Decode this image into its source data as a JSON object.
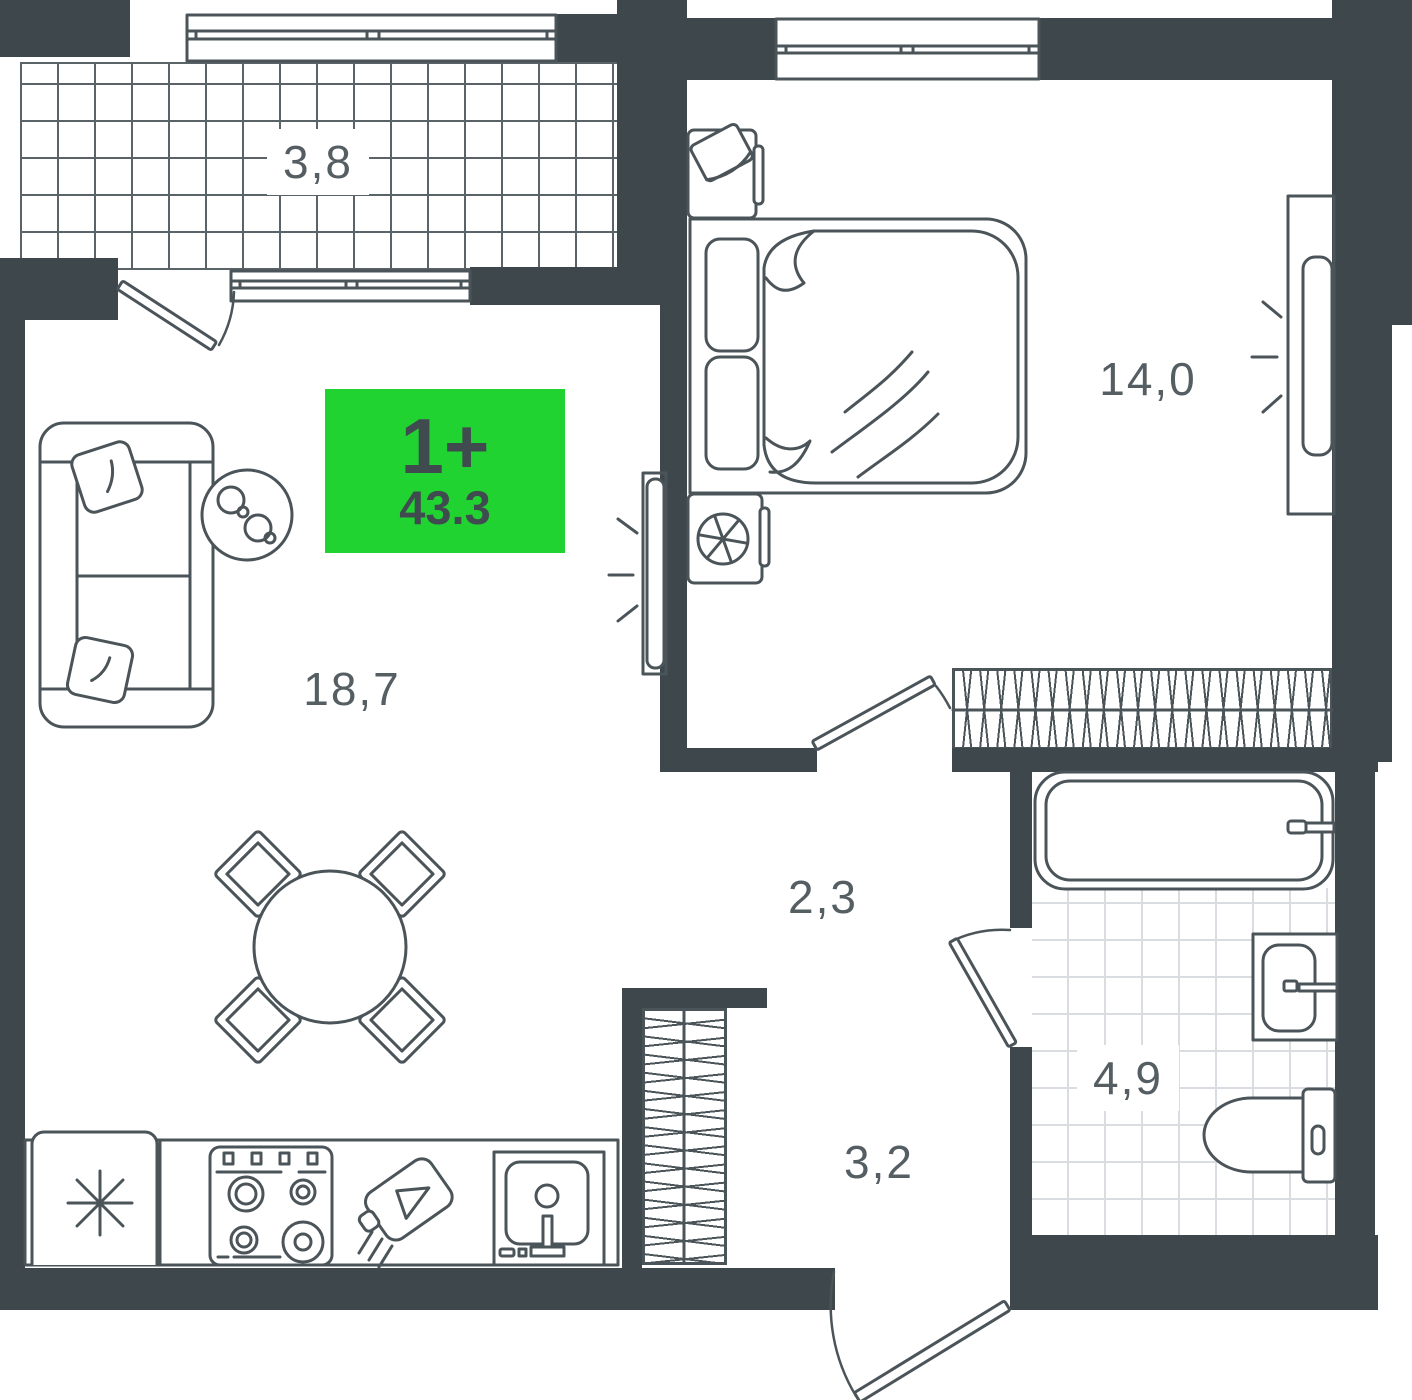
{
  "badge": {
    "rooms": "1+",
    "area": "43.3"
  },
  "rooms": {
    "balcony": {
      "area": "3,8"
    },
    "living": {
      "area": "18,7"
    },
    "bedroom": {
      "area": "14,0"
    },
    "hallway": {
      "area": "2,3"
    },
    "entry": {
      "area": "3,2"
    },
    "bathroom": {
      "area": "4,9"
    }
  },
  "colors": {
    "wall": "#3e474c",
    "line": "#4b5459",
    "hatch": "#5a6368",
    "tile": "#d9dce0",
    "accent": "#21d331",
    "label": "#555e63",
    "badgeText": "#404b50"
  }
}
